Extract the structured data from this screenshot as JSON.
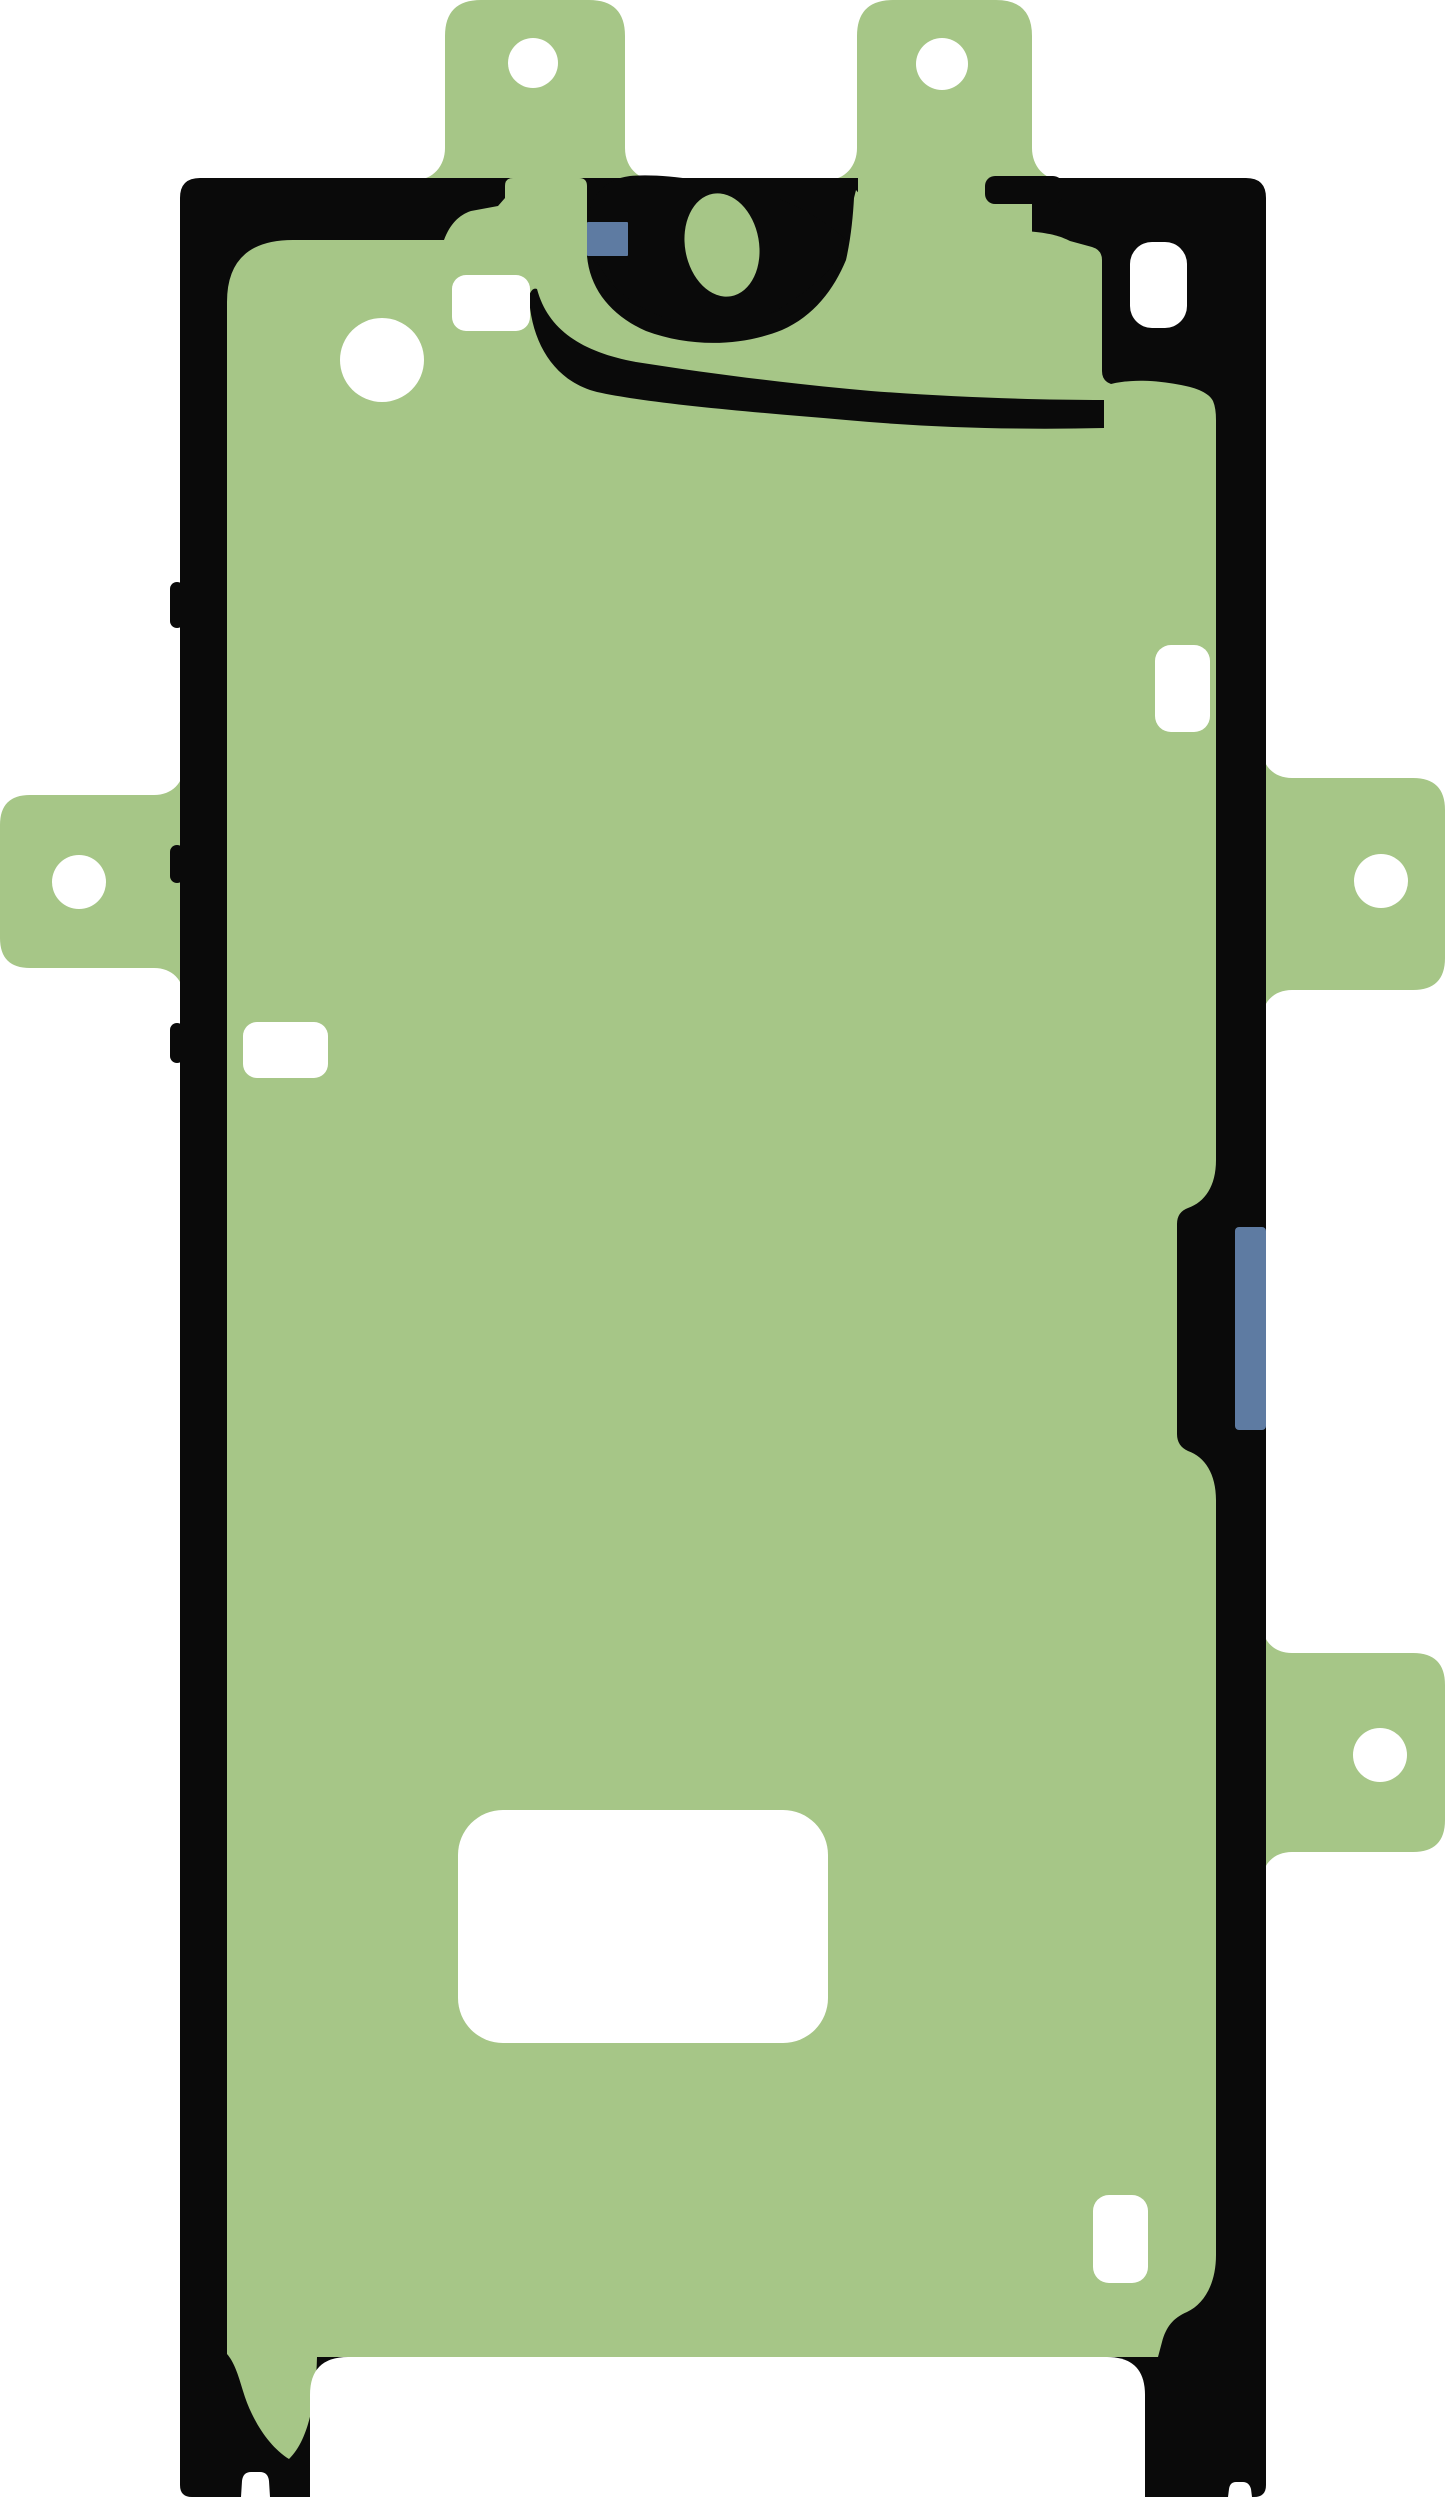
{
  "image": {
    "width": 1445,
    "height": 2497,
    "subject": "phone-display-adhesive-sticker",
    "description": "Die-cut green adhesive sticker sheet for a smartphone display, black outline frame, alignment tabs with punched holes, camera cutout, blue pull-tab markers, white die-cut openings"
  },
  "colors": {
    "background": "#ffffff",
    "adhesive_green": "#a6c687",
    "outline_black": "#0a0a0a",
    "marker_blue": "#5e7ba2",
    "cutout_white": "#ffffff"
  },
  "shapes": [
    {
      "name": "background",
      "type": "rect",
      "fill": "background",
      "x": 0,
      "y": 0,
      "w": 1445,
      "h": 2497,
      "r": 0
    },
    {
      "name": "tab-top-left",
      "type": "path",
      "fill": "adhesive_green",
      "d": "M 415,180 C 433,180 445,166 445,148 L 445,36 Q 445,0 481,0 L 589,0 Q 625,0 625,36 L 625,148 C 625,166 637,180 655,180 Z"
    },
    {
      "name": "tab-top-right",
      "type": "path",
      "fill": "adhesive_green",
      "d": "M 827,180 C 845,180 857,166 857,148 L 857,36 Q 857,0 893,0 L 996,0 Q 1032,0 1032,36 L 1032,148 C 1032,166 1044,180 1062,180 Z"
    },
    {
      "name": "tab-left",
      "type": "path",
      "fill": "adhesive_green",
      "d": "M 184,765 C 184,783 172,795 154,795 L 30,795 Q 0,795 0,825 L 0,938 Q 0,968 30,968 L 154,968 C 172,968 184,980 184,998 Z"
    },
    {
      "name": "tab-right-upper",
      "type": "path",
      "fill": "adhesive_green",
      "d": "M 1262,748 C 1262,766 1274,778 1292,778 L 1413,778 Q 1445,778 1445,810 L 1445,958 Q 1445,990 1413,990 L 1292,990 C 1274,990 1262,1002 1262,1020 Z"
    },
    {
      "name": "tab-right-lower",
      "type": "path",
      "fill": "adhesive_green",
      "d": "M 1262,1623 C 1262,1641 1274,1653 1292,1653 L 1413,1653 Q 1445,1653 1445,1685 L 1445,1820 Q 1445,1852 1413,1852 L 1292,1852 C 1274,1852 1262,1864 1262,1882 Z"
    },
    {
      "name": "outline-frame",
      "type": "path",
      "fill": "outline_black",
      "d": "M 200,178 L 1246,178 Q 1266,178 1266,198 L 1266,2485 Q 1266,2497 1254,2497 L 1252,2497 L 1251,2489 Q 1249,2482 1243,2482 L 1236,2482 Q 1230,2482 1229,2489 L 1228,2497 L 270,2497 L 269,2481 Q 268,2472 260,2472 L 251,2472 Q 243,2472 242,2481 L 241,2497 L 192,2497 Q 180,2497 180,2485 L 180,198 Q 180,178 200,178 Z"
    },
    {
      "name": "side-bump-upper",
      "type": "rect",
      "fill": "outline_black",
      "x": 170,
      "y": 582,
      "w": 14,
      "h": 46,
      "r": 7
    },
    {
      "name": "side-bump-middle",
      "type": "rect",
      "fill": "outline_black",
      "x": 170,
      "y": 845,
      "w": 14,
      "h": 38,
      "r": 7
    },
    {
      "name": "side-bump-lower",
      "type": "rect",
      "fill": "outline_black",
      "x": 170,
      "y": 1023,
      "w": 14,
      "h": 40,
      "r": 7
    },
    {
      "name": "tab-top-right-merge",
      "type": "rect",
      "fill": "adhesive_green",
      "x": 858,
      "y": 168,
      "w": 174,
      "h": 78,
      "r": 0
    },
    {
      "name": "outline-nose",
      "type": "rect",
      "fill": "outline_black",
      "x": 985,
      "y": 176,
      "w": 78,
      "h": 28,
      "r": 10
    },
    {
      "name": "adhesive-body",
      "type": "path",
      "fill": "adhesive_green",
      "d": "M 293,240 L 444,240 C 450,224 459,215 471,211 L 498,206 L 505,198 L 505,186 Q 505,178 513,178 L 579,178 Q 587,178 587,186 L 587,256 C 590,290 612,316 646,331 C 692,348 742,346 782,330 C 814,316 834,289 846,260 C 851,238 853,216 854,198 L 856,190 C 872,210 905,222 940,226 C 975,230 1010,229 1036,232 C 1054,234 1062,237 1070,241 L 1092,247 Q 1102,250 1102,260 L 1102,371 Q 1102,381 1111,384 C 1131,379 1156,380 1181,385 C 1197,388 1209,393 1213,401 Q 1216,408 1216,420 L 1216,1160 C 1216,1186 1205,1202 1188,1208 Q 1177,1212 1177,1224 L 1177,1434 Q 1177,1446 1188,1451 C 1205,1457 1216,1474 1216,1500 L 1216,2255 C 1216,2284 1204,2304 1187,2312 C 1173,2318 1166,2327 1162,2342 L 1158,2357 L 317,2357 C 316,2398 309,2440 289,2459 C 268,2446 251,2418 243,2391 C 238,2374 234,2362 227,2354 L 227,302 Q 227,240 293,240 Z"
    },
    {
      "name": "outline-sweep-band",
      "type": "path",
      "fill": "outline_black",
      "d": "M 537,289 C 548,330 582,352 636,362 C 712,374 792,384 871,391 C 950,397 1032,400 1104,400 L 1104,428 C 1022,430 932,428 846,420 C 751,412 652,404 597,392 C 553,381 531,341 529,296 Q 532,287 537,289 Z"
    },
    {
      "name": "camera-outline-blob",
      "type": "path",
      "fill": "outline_black",
      "d": "M 630,176 C 598,180 584,206 589,236 C 593,263 612,291 643,308 C 676,326 718,331 753,320 C 788,309 822,281 844,252 C 849,246 849,241 842,236 C 816,214 782,197 746,189 C 708,181 662,173 630,176 Z"
    },
    {
      "name": "camera-oval",
      "type": "ellipse",
      "fill": "adhesive_green",
      "cx": 722,
      "cy": 245,
      "rx": 37,
      "ry": 52,
      "rotate": -10
    },
    {
      "name": "blue-marker-top",
      "type": "rect",
      "fill": "marker_blue",
      "x": 587,
      "y": 222,
      "w": 41,
      "h": 34,
      "r": 1
    },
    {
      "name": "blue-marker-right",
      "type": "rect",
      "fill": "marker_blue",
      "x": 1235,
      "y": 1227,
      "w": 31,
      "h": 203,
      "r": 4
    },
    {
      "name": "hole-tab-top-left",
      "type": "circle",
      "fill": "cutout_white",
      "cx": 533,
      "cy": 63,
      "rx": 25
    },
    {
      "name": "hole-tab-top-right",
      "type": "circle",
      "fill": "cutout_white",
      "cx": 942,
      "cy": 64,
      "rx": 26
    },
    {
      "name": "hole-tab-left",
      "type": "circle",
      "fill": "cutout_white",
      "cx": 79,
      "cy": 882,
      "rx": 27
    },
    {
      "name": "hole-tab-right-upper",
      "type": "circle",
      "fill": "cutout_white",
      "cx": 1381,
      "cy": 881,
      "rx": 27
    },
    {
      "name": "hole-tab-right-lower",
      "type": "circle",
      "fill": "cutout_white",
      "cx": 1380,
      "cy": 1755,
      "rx": 27
    },
    {
      "name": "cutout-top-left-rect",
      "type": "rect",
      "fill": "cutout_white",
      "x": 452,
      "y": 275,
      "w": 78,
      "h": 56,
      "r": 14
    },
    {
      "name": "cutout-earpiece-circle",
      "type": "circle",
      "fill": "cutout_white",
      "cx": 382,
      "cy": 360,
      "rx": 42
    },
    {
      "name": "cutout-top-right-rect",
      "type": "rect",
      "fill": "cutout_white",
      "x": 1130,
      "y": 242,
      "w": 57,
      "h": 86,
      "r": 22
    },
    {
      "name": "cutout-right-mid-rect",
      "type": "rect",
      "fill": "cutout_white",
      "x": 1155,
      "y": 645,
      "w": 55,
      "h": 87,
      "r": 16
    },
    {
      "name": "cutout-left-mid-rect",
      "type": "rect",
      "fill": "cutout_white",
      "x": 243,
      "y": 1022,
      "w": 85,
      "h": 56,
      "r": 14
    },
    {
      "name": "cutout-bottom-large-rect",
      "type": "rect",
      "fill": "cutout_white",
      "x": 458,
      "y": 1810,
      "w": 370,
      "h": 233,
      "r": 45
    },
    {
      "name": "cutout-bottom-right-rect",
      "type": "rect",
      "fill": "cutout_white",
      "x": 1093,
      "y": 2195,
      "w": 55,
      "h": 88,
      "r": 16
    },
    {
      "name": "cutout-bottom-opening",
      "type": "path",
      "fill": "cutout_white",
      "d": "M 310,2395 Q 310,2357 348,2357 L 1107,2357 Q 1145,2357 1145,2395 L 1145,2497 L 310,2497 Z"
    }
  ]
}
